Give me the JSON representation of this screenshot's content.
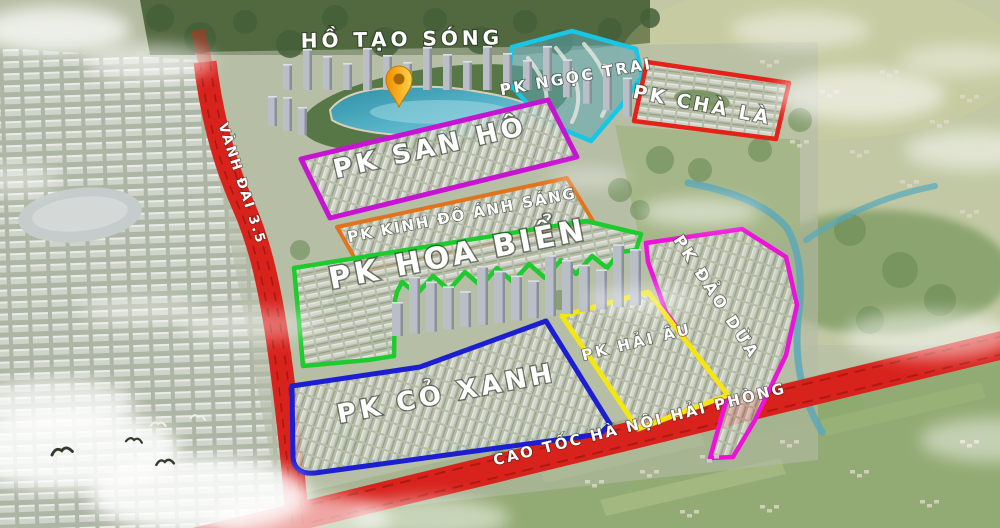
{
  "map": {
    "lake_label": "HỒ TẠO SÓNG",
    "label_color": "#ffffff",
    "zones": [
      {
        "id": "ngoc-trai",
        "label": "PK NGỌC TRAI",
        "color": "#18c6e6"
      },
      {
        "id": "cha-la",
        "label": "PK CHÀ LÀ",
        "color": "#e32219"
      },
      {
        "id": "san-ho",
        "label": "PK SAN HÔ",
        "color": "#c614d2"
      },
      {
        "id": "kinh-do-anh-sang",
        "label": "PK KINH ĐÔ ÁNH SÁNG",
        "color": "#e2731d"
      },
      {
        "id": "hoa-bien",
        "label": "PK HOA BIỂN",
        "color": "#1ecb2e"
      },
      {
        "id": "dao-dua",
        "label": "PK ĐẢO DỪA",
        "color": "#ec12d8"
      },
      {
        "id": "hai-au",
        "label": "PK HẢI ÂU",
        "color": "#f2e713"
      },
      {
        "id": "co-xanh",
        "label": "PK CỎ XANH",
        "color": "#1c1ed2"
      }
    ],
    "roads": [
      {
        "id": "vanh-dai-35",
        "label": "VÀNH ĐAI 3.5",
        "color": "#d8231d"
      },
      {
        "id": "cao-toc-hn-hp",
        "label": "CAO TỐC HÀ NỘI HẢI PHÒNG",
        "color": "#d8231d"
      }
    ],
    "marker": {
      "id": "location-pin",
      "color": "#f6a800"
    }
  }
}
